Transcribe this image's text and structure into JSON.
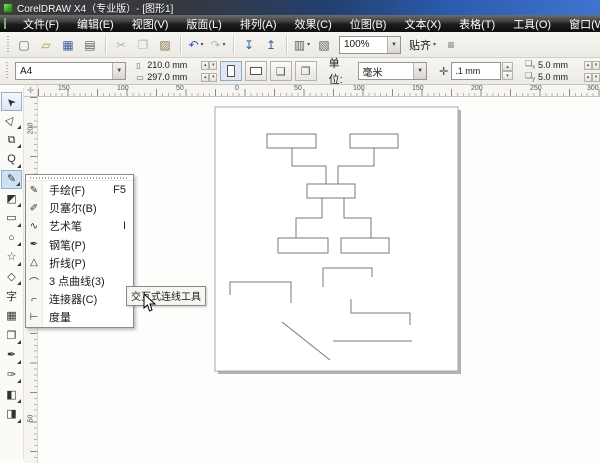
{
  "window": {
    "title": "CorelDRAW X4（专业版）- [图形1]"
  },
  "menu_bar": {
    "items": [
      {
        "name": "file",
        "label": "文件(F)"
      },
      {
        "name": "edit",
        "label": "编辑(E)"
      },
      {
        "name": "view",
        "label": "视图(V)"
      },
      {
        "name": "layout",
        "label": "版面(L)"
      },
      {
        "name": "arrange",
        "label": "排列(A)"
      },
      {
        "name": "effects",
        "label": "效果(C)"
      },
      {
        "name": "bitmaps",
        "label": "位图(B)"
      },
      {
        "name": "text",
        "label": "文本(X)"
      },
      {
        "name": "table",
        "label": "表格(T)"
      },
      {
        "name": "tools",
        "label": "工具(O)"
      },
      {
        "name": "window",
        "label": "窗口(W)"
      },
      {
        "name": "help",
        "label": "帮助(H)"
      }
    ]
  },
  "standard_toolbar": {
    "zoom_value": "100%",
    "snap_label": "贴齐",
    "items": [
      {
        "type": "button",
        "name": "new-document",
        "glyph": "▢",
        "color": "#4a6b8a"
      },
      {
        "type": "button",
        "name": "open",
        "glyph": "▱",
        "color": "#b9924a"
      },
      {
        "type": "button",
        "name": "save",
        "glyph": "▦",
        "color": "#3d5f9e"
      },
      {
        "type": "button",
        "name": "print",
        "glyph": "▤",
        "color": "#5a6168"
      },
      {
        "type": "sep"
      },
      {
        "type": "button",
        "name": "cut",
        "glyph": "✂",
        "disabled": true
      },
      {
        "type": "button",
        "name": "copy",
        "glyph": "❐",
        "disabled": true
      },
      {
        "type": "button",
        "name": "paste",
        "glyph": "▨",
        "color": "#8a7648"
      },
      {
        "type": "sep"
      },
      {
        "type": "button",
        "name": "undo",
        "glyph": "↶",
        "color": "#2f5fbf",
        "dropdown": true
      },
      {
        "type": "button",
        "name": "redo",
        "glyph": "↷",
        "disabled": true,
        "dropdown": true
      },
      {
        "type": "sep"
      },
      {
        "type": "button",
        "name": "import",
        "glyph": "↧",
        "color": "#35629e"
      },
      {
        "type": "button",
        "name": "export",
        "glyph": "↥",
        "color": "#35629e"
      },
      {
        "type": "sep"
      },
      {
        "type": "button",
        "name": "application-launcher",
        "glyph": "▥",
        "color": "#5a6168",
        "dropdown": true
      },
      {
        "type": "button",
        "name": "welcome-screen",
        "glyph": "▧",
        "color": "#5a6168"
      },
      {
        "type": "zoom-combo"
      },
      {
        "type": "snap-button"
      },
      {
        "type": "button",
        "name": "options",
        "glyph": "≡",
        "color": "#5a6168"
      }
    ]
  },
  "property_bar": {
    "paper_size": "A4",
    "paper_width": "210.0 mm",
    "paper_height": "297.0 mm",
    "units_label": "单位:",
    "units_value": "毫米",
    "nudge_offset": ".1 mm",
    "duplicate_x": "5.0 mm",
    "duplicate_y": "5.0 mm"
  },
  "rulers": {
    "h_labels": [
      {
        "text": "150",
        "x": 63
      },
      {
        "text": "100",
        "x": 122
      },
      {
        "text": "50",
        "x": 181
      },
      {
        "text": "0",
        "x": 240
      },
      {
        "text": "50",
        "x": 299
      },
      {
        "text": "100",
        "x": 358
      },
      {
        "text": "150",
        "x": 417
      },
      {
        "text": "200",
        "x": 476
      },
      {
        "text": "250",
        "x": 535
      },
      {
        "text": "300",
        "x": 592
      }
    ],
    "v_labels": [
      {
        "text": "200",
        "y": 130
      },
      {
        "text": "50",
        "y": 420
      }
    ]
  },
  "toolbox": {
    "tools": [
      {
        "name": "pick-tool",
        "glyph": "➤",
        "rot": -135,
        "state": "selected"
      },
      {
        "name": "shape-tool",
        "glyph": "▷",
        "rot": -50,
        "flyout": true
      },
      {
        "name": "crop-tool",
        "glyph": "⧉",
        "flyout": true
      },
      {
        "name": "zoom-tool",
        "glyph": "Q",
        "flyout": true
      },
      {
        "name": "freehand-tool",
        "glyph": "✎",
        "flyout": true,
        "state": "active"
      },
      {
        "name": "smart-fill-tool",
        "glyph": "◩",
        "flyout": true
      },
      {
        "name": "rectangle-tool",
        "glyph": "▭",
        "flyout": true
      },
      {
        "name": "ellipse-tool",
        "glyph": "○",
        "flyout": true
      },
      {
        "name": "polygon-tool",
        "glyph": "☆",
        "flyout": true
      },
      {
        "name": "basic-shapes-tool",
        "glyph": "◇",
        "flyout": true
      },
      {
        "name": "text-tool",
        "glyph": "字"
      },
      {
        "name": "table-tool",
        "glyph": "▦"
      },
      {
        "name": "blend-tool",
        "glyph": "❐",
        "flyout": true
      },
      {
        "name": "eyedropper-tool",
        "glyph": "✒",
        "flyout": true
      },
      {
        "name": "outline-tool",
        "glyph": "✑",
        "flyout": true
      },
      {
        "name": "fill-tool",
        "glyph": "◧",
        "flyout": true
      },
      {
        "name": "interactive-fill-tool",
        "glyph": "◨",
        "flyout": true
      }
    ]
  },
  "flyout_menu": {
    "items": [
      {
        "name": "freehand",
        "label": "手绘(F)",
        "shortcut": "F5",
        "glyph": "✎"
      },
      {
        "name": "bezier",
        "label": "贝塞尔(B)",
        "shortcut": "",
        "glyph": "✐"
      },
      {
        "name": "artistic-media",
        "label": "艺术笔",
        "shortcut": "I",
        "glyph": "∿"
      },
      {
        "name": "pen",
        "label": "钢笔(P)",
        "shortcut": "",
        "glyph": "✒"
      },
      {
        "name": "polyline",
        "label": "折线(P)",
        "shortcut": "",
        "glyph": "△"
      },
      {
        "name": "three-point-curve",
        "label": "3 点曲线(3)",
        "shortcut": "",
        "glyph": "⌒"
      },
      {
        "name": "connector",
        "label": "连接器(C)",
        "shortcut": "",
        "glyph": "⌐"
      },
      {
        "name": "dimension",
        "label": "度量",
        "shortcut": "",
        "glyph": "⊢"
      }
    ]
  },
  "tooltip": {
    "text": "交互式连线工具"
  },
  "colors": {
    "titlebar_blue": "#3f74cf",
    "active_tool_bg": "#cfe0f1",
    "page_border": "#a8a8a8",
    "page_shadow": "#b2b1ad",
    "shape_stroke": "#787878",
    "tooltip_bg": "#f6f5ef"
  },
  "canvas": {
    "page": {
      "x": 215,
      "y": 107,
      "w": 243,
      "h": 264
    },
    "rects": [
      [
        267,
        134,
        49,
        14
      ],
      [
        350,
        134,
        48,
        14
      ],
      [
        307,
        184,
        48,
        14
      ],
      [
        278,
        238,
        50,
        15
      ],
      [
        341,
        238,
        48,
        15
      ]
    ],
    "polylines": [
      [
        [
          292,
          148
        ],
        [
          292,
          166
        ],
        [
          326,
          166
        ],
        [
          326,
          184
        ]
      ],
      [
        [
          374,
          148
        ],
        [
          374,
          166
        ],
        [
          338,
          166
        ],
        [
          338,
          184
        ]
      ],
      [
        [
          322,
          198
        ],
        [
          322,
          218
        ],
        [
          296,
          218
        ],
        [
          296,
          238
        ]
      ],
      [
        [
          344,
          198
        ],
        [
          344,
          218
        ],
        [
          371,
          218
        ],
        [
          371,
          238
        ]
      ],
      [
        [
          323,
          287
        ],
        [
          323,
          268
        ],
        [
          372,
          268
        ],
        [
          372,
          277
        ]
      ],
      [
        [
          230,
          295
        ],
        [
          230,
          282
        ],
        [
          291,
          282
        ],
        [
          291,
          303
        ]
      ],
      [
        [
          351,
          299
        ],
        [
          351,
          313
        ],
        [
          410,
          313
        ],
        [
          410,
          325
        ]
      ],
      [
        [
          282,
          322
        ],
        [
          330,
          360
        ]
      ],
      [
        [
          333,
          341
        ],
        [
          412,
          341
        ]
      ]
    ]
  }
}
